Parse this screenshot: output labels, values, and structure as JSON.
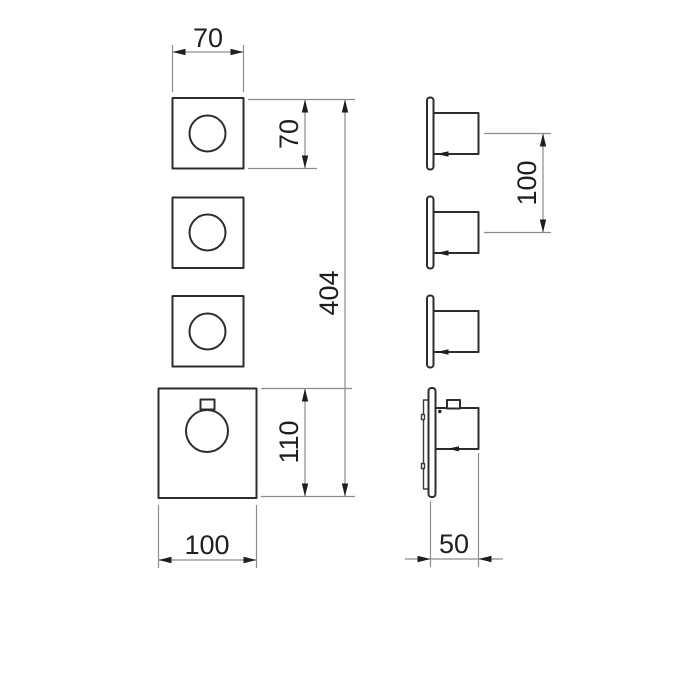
{
  "drawing": {
    "type": "technical-dimension-drawing",
    "subject": "concealed thermostatic shower mixer, front and side views",
    "colors": {
      "background": "#ffffff",
      "object_line": "#2d2d2d",
      "dimension_line": "#8c8c8c",
      "dimension_text": "#1f1f1f"
    },
    "front_view": {
      "dim_small_plate_width": "70",
      "dim_small_plate_height": "70",
      "dim_total_height": "404",
      "dim_main_plate_height": "110",
      "dim_main_plate_width": "100"
    },
    "side_view": {
      "dim_handle_spacing": "100",
      "dim_projection": "50"
    }
  }
}
